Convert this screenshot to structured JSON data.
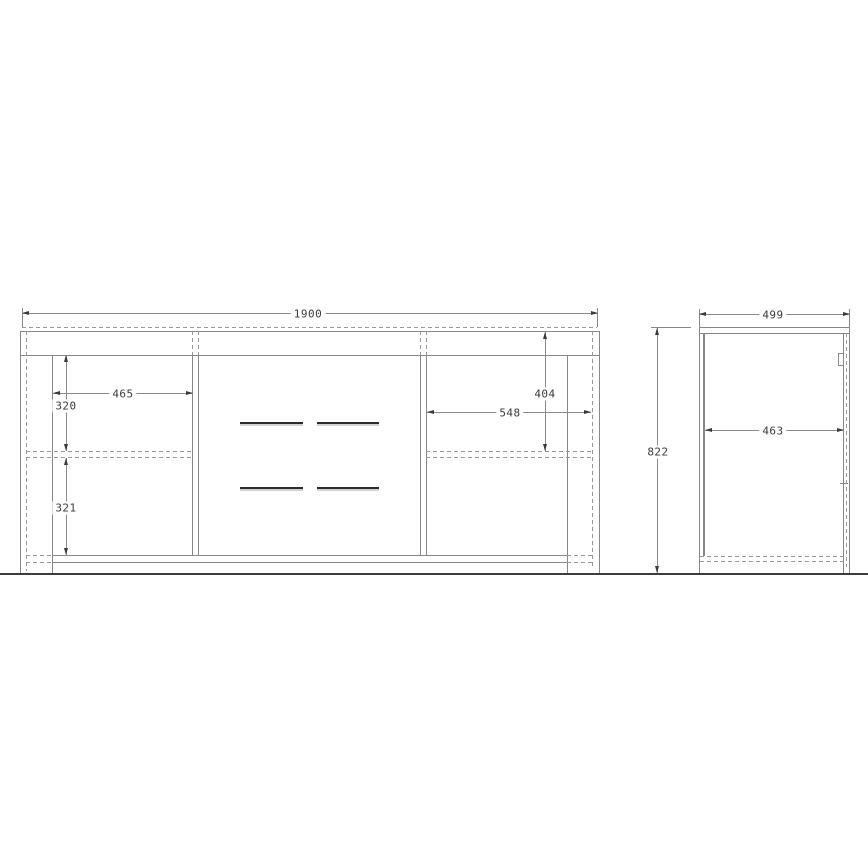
{
  "views": {
    "front": {
      "dims": {
        "total_width": "1900",
        "left_compartment_width": "465",
        "left_upper_compartment_height": "320",
        "left_lower_compartment_height": "321",
        "right_compartment_width": "548",
        "right_upper_compartment_height": "404",
        "total_height": "822"
      }
    },
    "side": {
      "dims": {
        "total_depth": "499",
        "inner_depth": "463"
      }
    }
  },
  "colors": {
    "line": "#878787",
    "dark_line": "#2c2c2c",
    "dimension_text": "#3a3a3a",
    "background": "#ffffff"
  }
}
